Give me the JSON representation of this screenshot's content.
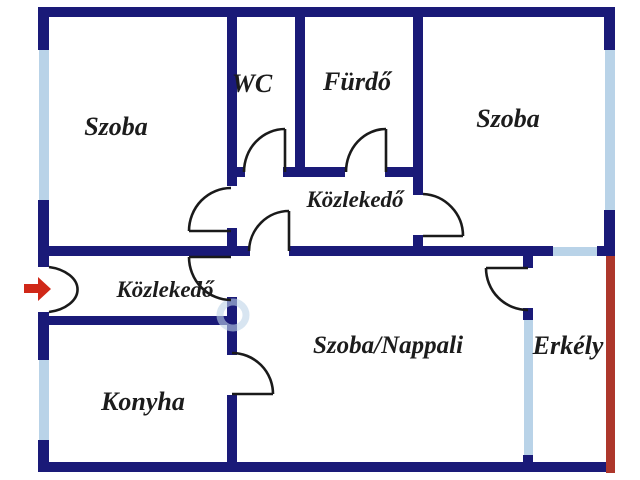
{
  "floor_plan": {
    "labels": {
      "szoba_top_left": "Szoba",
      "wc": "WC",
      "furdo": "Fürdő",
      "szoba_top_right": "Szoba",
      "kozlekedo_central": "Közlekedő",
      "kozlekedo_entry": "Közlekedő",
      "szoba_nappali": "Szoba/Nappali",
      "konyha": "Konyha",
      "erkely": "Erkély"
    },
    "colors": {
      "background": "#ffffff",
      "wall": "#1a1a78",
      "window": "#b9d3e8",
      "balcony_rail": "#ad372b",
      "entrance_arrow": "#d02818",
      "door_line": "#1a1a1a",
      "label_text": "#1c1c1c",
      "watermark": "#bed3e7"
    },
    "icons": {
      "entrance_arrow": "right-arrow"
    }
  }
}
